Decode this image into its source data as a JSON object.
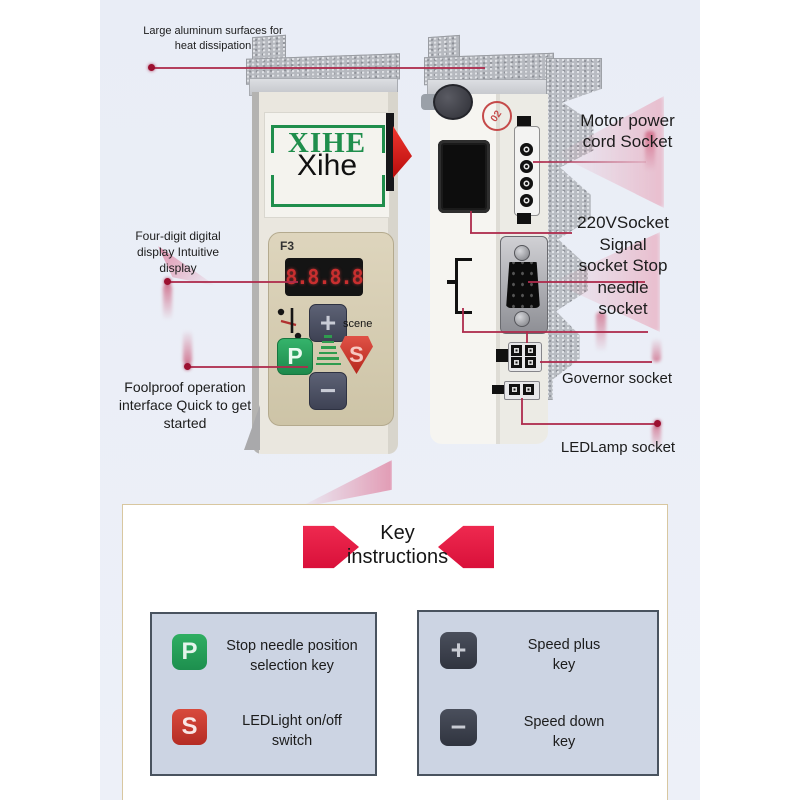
{
  "callouts": {
    "heat": [
      "Large aluminum surfaces for",
      "heat dissipation"
    ],
    "display": [
      "Four-digit digital",
      "display Intuitive",
      "display"
    ],
    "foolproof": [
      "Foolproof operation",
      "interface Quick to get",
      "started"
    ],
    "motor": [
      "Motor power",
      "cord Socket"
    ],
    "socket220": [
      "220VSocket",
      "Signal",
      "socket Stop",
      "needle",
      "socket"
    ],
    "governor": "Governor socket",
    "led": "LEDLamp socket"
  },
  "device_front": {
    "logo_bg_text": "XIHE",
    "logo_overlay_text": "Xihe",
    "model_label": "F3",
    "display_value": "8.8.8.8",
    "plus_label": "+",
    "minus_label": "−",
    "p_label": "P",
    "s_label": "S",
    "scene_label": "scene"
  },
  "device_side": {
    "sticker_label": "02"
  },
  "key_section": {
    "title": [
      "Key",
      "instructions"
    ],
    "left_box": [
      {
        "key": "P",
        "desc": [
          "Stop needle position",
          "selection key"
        ]
      },
      {
        "key": "S",
        "desc": [
          "LEDLight on/off",
          "switch"
        ]
      }
    ],
    "right_box": [
      {
        "key": "+",
        "desc": [
          "Speed plus",
          "key"
        ]
      },
      {
        "key": "−",
        "desc": [
          "Speed down",
          "key"
        ]
      }
    ]
  },
  "colors": {
    "accent_red": "#e5173f",
    "annotation_red": "#ae2b4d",
    "p_green": "#23a258",
    "s_red": "#cf3a31",
    "speed_key_dark": "#3c414d",
    "band_blue": "#e9edf6",
    "panel_khaki": "#d6cdb2",
    "logo_green": "#1f8e4c"
  }
}
